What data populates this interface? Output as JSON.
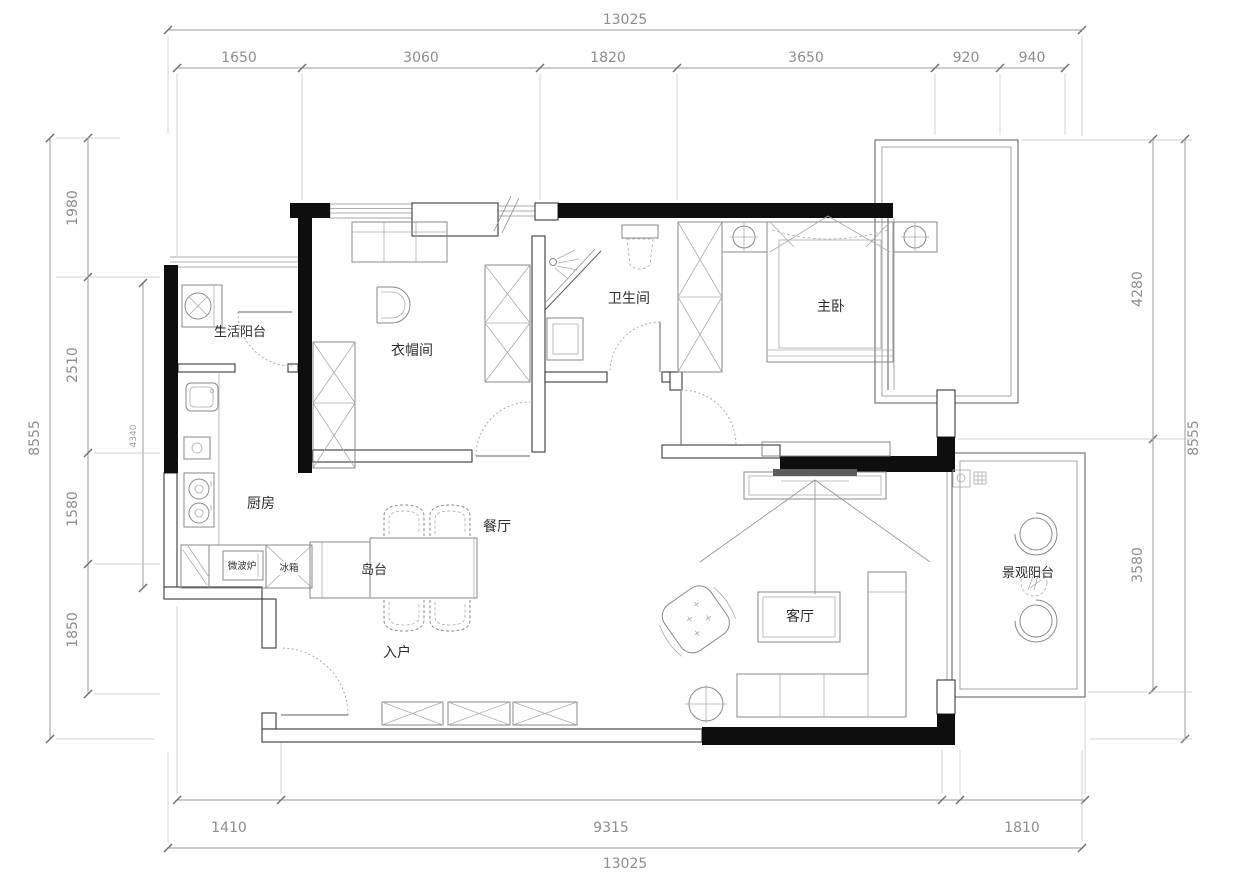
{
  "plan": {
    "dims": {
      "top_total": "13025",
      "top_segments": [
        "1650",
        "3060",
        "1820",
        "3650",
        "920",
        "940"
      ],
      "left_total": "8555",
      "left_segments": [
        "1980",
        "2510",
        "1580",
        "1850"
      ],
      "left_inner": "4340",
      "right_total": "8555",
      "right_segments": [
        "4280",
        "3580"
      ],
      "bottom_total": "13025",
      "bottom_segments": [
        "1410",
        "9315",
        "1810"
      ]
    },
    "rooms": {
      "service_balcony": "生活阳台",
      "cloakroom": "衣帽间",
      "bathroom": "卫生间",
      "master_bedroom": "主卧",
      "kitchen": "厨房",
      "dining": "餐厅",
      "island": "岛台",
      "entry": "入户",
      "living": "客厅",
      "view_balcony": "景观阳台"
    },
    "appliances": {
      "microwave": "微波炉",
      "fridge": "冰箱"
    }
  }
}
